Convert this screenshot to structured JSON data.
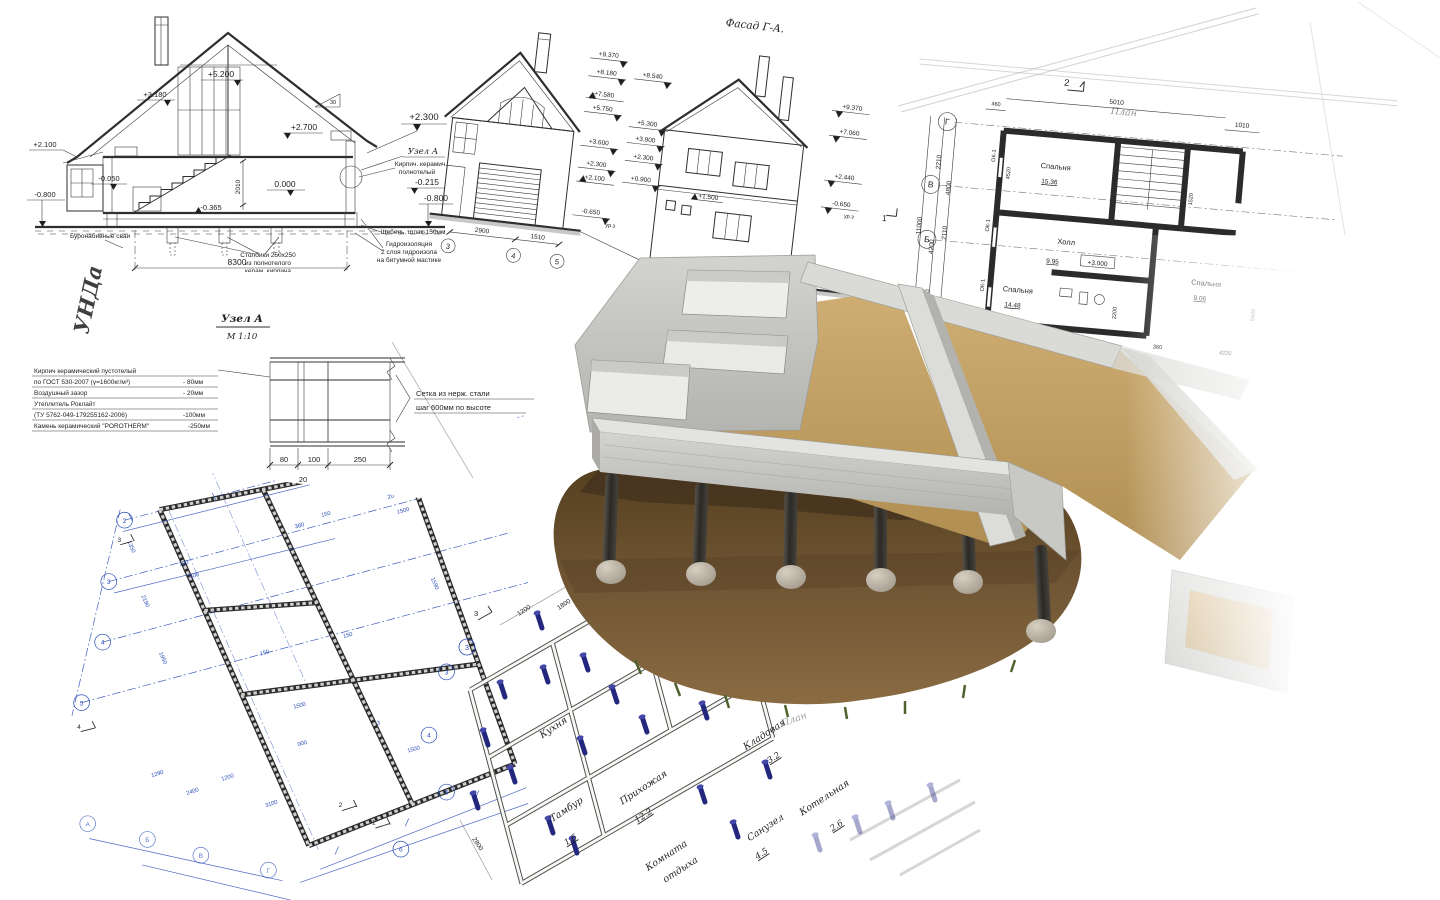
{
  "section_drawing": {
    "elevations": {
      "peak": "+5.200",
      "attic": "+3.180",
      "ceiling": "+2.700",
      "eave_left": "+2.100",
      "floor_minus": "-0.050",
      "zero": "0.000",
      "under_floor": "-0.365",
      "ground_left": "-0.800",
      "right_top": "+2.300",
      "right_mid": "-0.215",
      "ground_right": "-0.800"
    },
    "dims": {
      "width": "8300",
      "height": "2010"
    },
    "slope": "30",
    "axis": {
      "left": "1",
      "right": "2"
    },
    "notes": {
      "uzel": "Узел А",
      "brick1": "Кирпич. керамич.",
      "brick2": "полнотелый",
      "gravel": "Щебень, шлак-150мм",
      "wp1": "Гидроизоляция",
      "wp2": "2 слоя гидроизола",
      "wp3": "на битумной мастике",
      "piles": "Буронабивные сваи",
      "posts1": "Столбики 250х250",
      "posts2": "из полнотелого",
      "posts3": "керам. кирпича"
    }
  },
  "facade": {
    "title": "Фасад Г-А.",
    "left_marks": [
      "+9.370",
      "+8.180",
      "+7.580",
      "+5.750",
      "+3.600",
      "+2.300",
      "+2.100",
      "-0.650"
    ],
    "mid_marks": [
      "+8.540",
      "+5.300",
      "+3.900",
      "+2.300",
      "+0.900"
    ],
    "wall_mark": "+1.500",
    "right_marks": [
      "+9.370",
      "+7.060",
      "+2.440",
      "-0.650"
    ],
    "ground_note": "ур.з",
    "dims": [
      "2900",
      "1510",
      "4800",
      "4200",
      "11000"
    ],
    "axes": [
      "3",
      "4",
      "5",
      "Г",
      "В"
    ],
    "cut_mark": "1"
  },
  "plan_top": {
    "section_mark": "2",
    "sheet_label": "План",
    "axes": [
      "Г",
      "В",
      "Б"
    ],
    "dims_top": [
      "460",
      "5010",
      "1010"
    ],
    "dims_left": [
      "2210",
      "4800",
      "2110",
      "11000",
      "4200",
      "2020"
    ],
    "window_mark": "ОК-1",
    "level_mark": "+3.000",
    "rooms": [
      {
        "name": "Спальня",
        "area": "15.36"
      },
      {
        "name": "Холл",
        "area": "9.95"
      },
      {
        "name": "Спальня",
        "area": "14.48"
      },
      {
        "name": "Спальня",
        "area": "9.06"
      }
    ],
    "dims_inner": [
      "4520",
      "3420",
      "3800",
      "4120",
      "2200",
      "1520",
      "380",
      "4220",
      "5420"
    ]
  },
  "uzel": {
    "title": "Узел А",
    "scale": "М 1:10",
    "legend": [
      {
        "t": "Кирпич керамический пустотелый",
        "v": ""
      },
      {
        "t": "по ГОСТ 530-2007 (γ=1600кг/м³)",
        "v": "- 80мм"
      },
      {
        "t": "Воздушный зазор",
        "v": "- 20мм"
      },
      {
        "t": "Утеплитель Роклайт",
        "v": ""
      },
      {
        "t": "(ТУ 5762-049-179255162-2006)",
        "v": "-100мм"
      },
      {
        "t": "Камень керамический \"POROTHERM\"",
        "v": "-250мм"
      }
    ],
    "callout1": "Сетка из нерж. стали",
    "callout2": "шаг 600мм по высоте",
    "dims": [
      "80",
      "100",
      "250",
      "20"
    ],
    "watermark": "УНДа"
  },
  "blueprint": {
    "axes_left": [
      "2",
      "3",
      "4",
      "5"
    ],
    "axes_right": [
      "3",
      "4",
      "5",
      "6"
    ],
    "axes_bottom": [
      "А",
      "Б",
      "В",
      "Г"
    ],
    "cut_marks": [
      "3",
      "4",
      "2",
      "1"
    ],
    "dims": [
      "100",
      "300",
      "380",
      "150",
      "150",
      "150",
      "1500",
      "3000",
      "1500",
      "1290",
      "2400",
      "1200",
      "3100",
      "20",
      "1500",
      "1350",
      "2190",
      "1950",
      "1590"
    ]
  },
  "sketch": {
    "rooms": {
      "kitchen": "Кухня",
      "tambour": "Тамбур",
      "hallway": "Прихожая",
      "storage": "Кладовая",
      "wc": "Санузел",
      "boiler": "Котельная",
      "rest1": "Комната",
      "rest2": "отдыха"
    },
    "areas": {
      "tambour": "1.6",
      "hallway": "12.2",
      "storage": "3.2",
      "wc": "4.5",
      "boiler": "2.6"
    },
    "dims": [
      "1200",
      "1800",
      "2800"
    ],
    "axis": "3",
    "cut_mark": "3",
    "sheet_label": "План"
  },
  "colors": {
    "blueprint_blue": "#2a4db8",
    "pin_navy": "#23277e",
    "concrete": "#cfcfcb",
    "sand": "#c2a068",
    "soil": "#6e5536",
    "pile": "#33302b"
  }
}
